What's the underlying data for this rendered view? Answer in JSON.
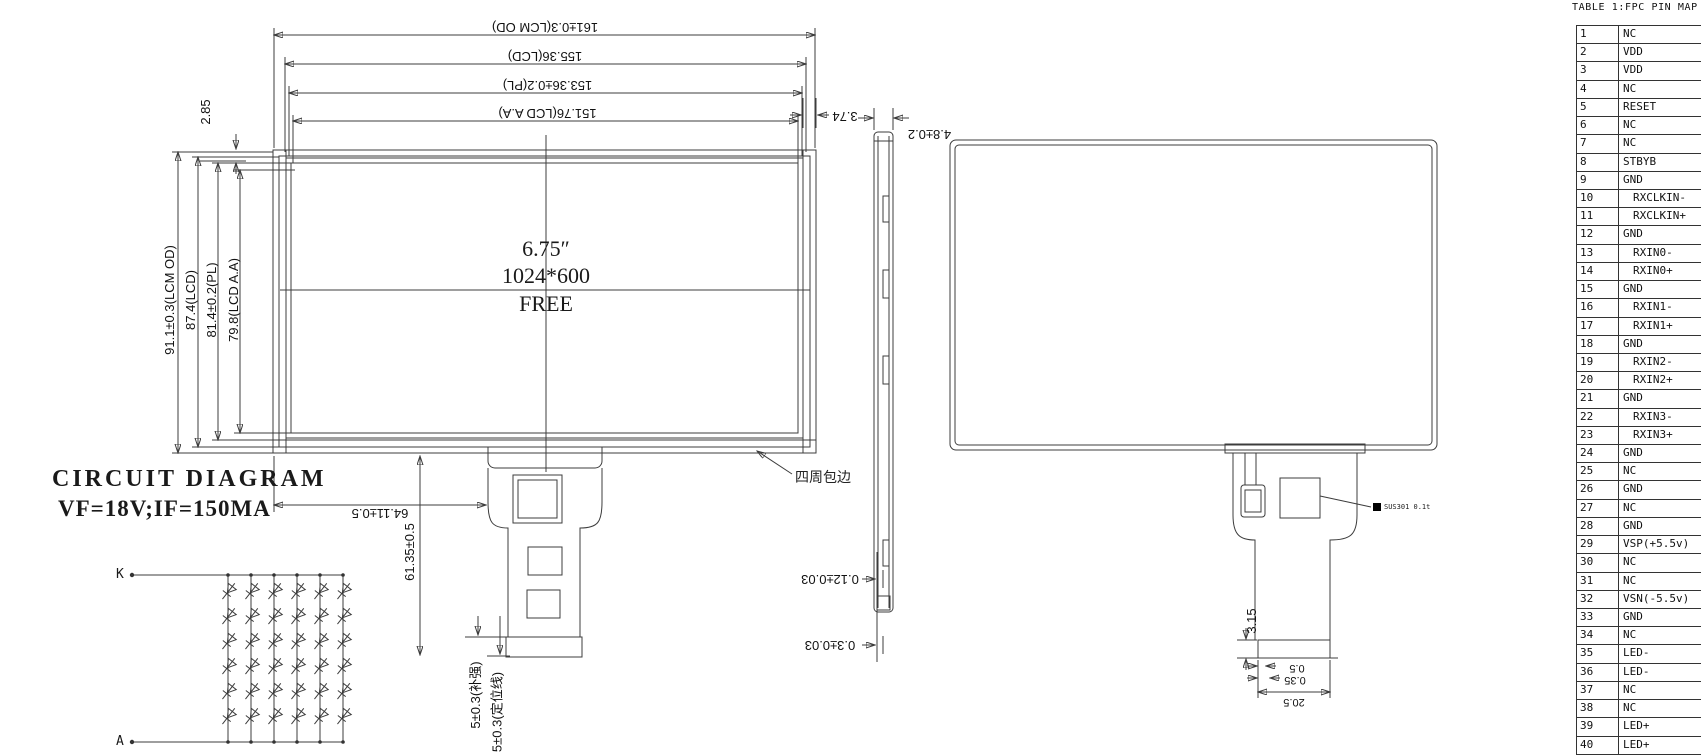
{
  "pin_table": {
    "title": "TABLE 1:FPC PIN MAP",
    "pins": [
      {
        "no": "1",
        "name": "NC"
      },
      {
        "no": "2",
        "name": "VDD"
      },
      {
        "no": "3",
        "name": "VDD"
      },
      {
        "no": "4",
        "name": "NC"
      },
      {
        "no": "5",
        "name": "RESET"
      },
      {
        "no": "6",
        "name": "NC"
      },
      {
        "no": "7",
        "name": "NC"
      },
      {
        "no": "8",
        "name": "STBYB"
      },
      {
        "no": "9",
        "name": "GND"
      },
      {
        "no": "10",
        "name": "RXCLKIN-"
      },
      {
        "no": "11",
        "name": "RXCLKIN+"
      },
      {
        "no": "12",
        "name": "GND"
      },
      {
        "no": "13",
        "name": "RXIN0-"
      },
      {
        "no": "14",
        "name": "RXIN0+"
      },
      {
        "no": "15",
        "name": "GND"
      },
      {
        "no": "16",
        "name": "RXIN1-"
      },
      {
        "no": "17",
        "name": "RXIN1+"
      },
      {
        "no": "18",
        "name": "GND"
      },
      {
        "no": "19",
        "name": "RXIN2-"
      },
      {
        "no": "20",
        "name": "RXIN2+"
      },
      {
        "no": "21",
        "name": "GND"
      },
      {
        "no": "22",
        "name": "RXIN3-"
      },
      {
        "no": "23",
        "name": "RXIN3+"
      },
      {
        "no": "24",
        "name": "GND"
      },
      {
        "no": "25",
        "name": "NC"
      },
      {
        "no": "26",
        "name": "GND"
      },
      {
        "no": "27",
        "name": "NC"
      },
      {
        "no": "28",
        "name": "GND"
      },
      {
        "no": "29",
        "name": "VSP(+5.5v)"
      },
      {
        "no": "30",
        "name": "NC"
      },
      {
        "no": "31",
        "name": "NC"
      },
      {
        "no": "32",
        "name": "VSN(-5.5v)"
      },
      {
        "no": "33",
        "name": "GND"
      },
      {
        "no": "34",
        "name": "NC"
      },
      {
        "no": "35",
        "name": "LED-"
      },
      {
        "no": "36",
        "name": "LED-"
      },
      {
        "no": "37",
        "name": "NC"
      },
      {
        "no": "38",
        "name": "NC"
      },
      {
        "no": "39",
        "name": "LED+"
      },
      {
        "no": "40",
        "name": "LED+"
      }
    ]
  },
  "front_view": {
    "center_size": "6.75″",
    "center_resolution": "1024*600",
    "center_brand": "FREE",
    "dims_top": [
      "161±0.3(LCM OD)",
      "155.36(LCD)",
      "153.36±0.2(PL)",
      "151.76(LCD A.A)"
    ],
    "dims_left": [
      "91.1±0.3(LCM OD)",
      "87.4(LCD)",
      "81.4±0.2(PL)",
      "79.8(LCD A.A)"
    ],
    "dim_bezel_top": "2.85",
    "dim_corner_right": "3.74",
    "dim_fpc_offset": "64.11±0.5",
    "dim_fpc_length": "61.35±0.5",
    "dim_stiffener": "5±0.3(补强)",
    "dim_positioning": "5±0.3(定位线)",
    "edge_note": "四周包边"
  },
  "side_view": {
    "dim_thickness": "4.8±0.2",
    "dim_film": "0.12±0.03",
    "dim_tape": "0.3±0.03"
  },
  "back_view": {
    "stiffener_label": "SUS301 0.1t",
    "dim_tail": "3.15",
    "dim_pitch": "0.5",
    "dim_finger": "0.35",
    "dim_connector_width": "20.5"
  },
  "circuit": {
    "title": "CIRCUIT DIAGRAM",
    "condition": "VF=18V;IF=150MA",
    "cathode_label": "K",
    "anode_label": "A",
    "strings": 6,
    "leds_per_string": 6
  }
}
